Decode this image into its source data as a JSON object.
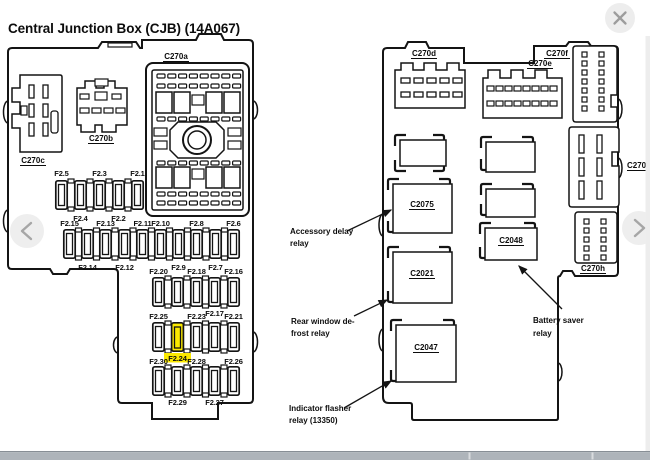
{
  "title": "Central Junction Box (CJB) (14A067)",
  "front": {
    "connectors": {
      "c270a": "C270a",
      "c270b": "C270b",
      "c270c": "C270c"
    },
    "fuses": {
      "f2_1": "F2.1",
      "f2_2": "F2.2",
      "f2_3": "F2.3",
      "f2_4": "F2.4",
      "f2_5": "F2.5",
      "f2_6": "F2.6",
      "f2_7": "F2.7",
      "f2_8": "F2.8",
      "f2_9": "F2.9",
      "f2_10": "F2.10",
      "f2_11": "F2.11",
      "f2_12": "F2.12",
      "f2_13": "F2.13",
      "f2_14": "F2.14",
      "f2_15": "F2.15",
      "f2_16": "F2.16",
      "f2_17": "F2.17",
      "f2_18": "F2.18",
      "f2_20": "F2.20",
      "f2_21": "F2.21",
      "f2_23": "F2.23",
      "f2_24": "F2.24",
      "f2_25": "F2.25",
      "f2_26": "F2.26",
      "f2_27": "F2.27",
      "f2_28": "F2.28",
      "f2_29": "F2.29",
      "f2_30": "F2.30"
    },
    "highlighted_fuse": "F2.24"
  },
  "rear": {
    "connectors": {
      "c270d": "C270d",
      "c270e": "C270e",
      "c270f": "C270f",
      "c270g": "C270g",
      "c270h": "C270h"
    },
    "relays": {
      "c2075": "C2075",
      "c2021": "C2021",
      "c2047": "C2047",
      "c2048": "C2048"
    }
  },
  "annotations": {
    "accessory_delay": {
      "line1": "Accessory delay",
      "line2": "relay"
    },
    "rear_window": {
      "line1": "Rear window de-",
      "line2": "frost relay"
    },
    "indicator_flasher": {
      "line1": "Indicator flasher",
      "line2": "relay (13350)"
    },
    "battery_saver": {
      "line1": "Battery saver",
      "line2": "relay"
    }
  },
  "icons": {
    "close": "close-icon",
    "prev": "chevron-left-icon",
    "next": "chevron-right-icon"
  },
  "colors": {
    "highlight": "#fbe900",
    "line": "#141414",
    "chrome_bg": "#ededed",
    "chrome_icon": "#a6a6a6",
    "bottom_bar": "#aeb4ba",
    "bottom_bar_border": "#878e95"
  }
}
